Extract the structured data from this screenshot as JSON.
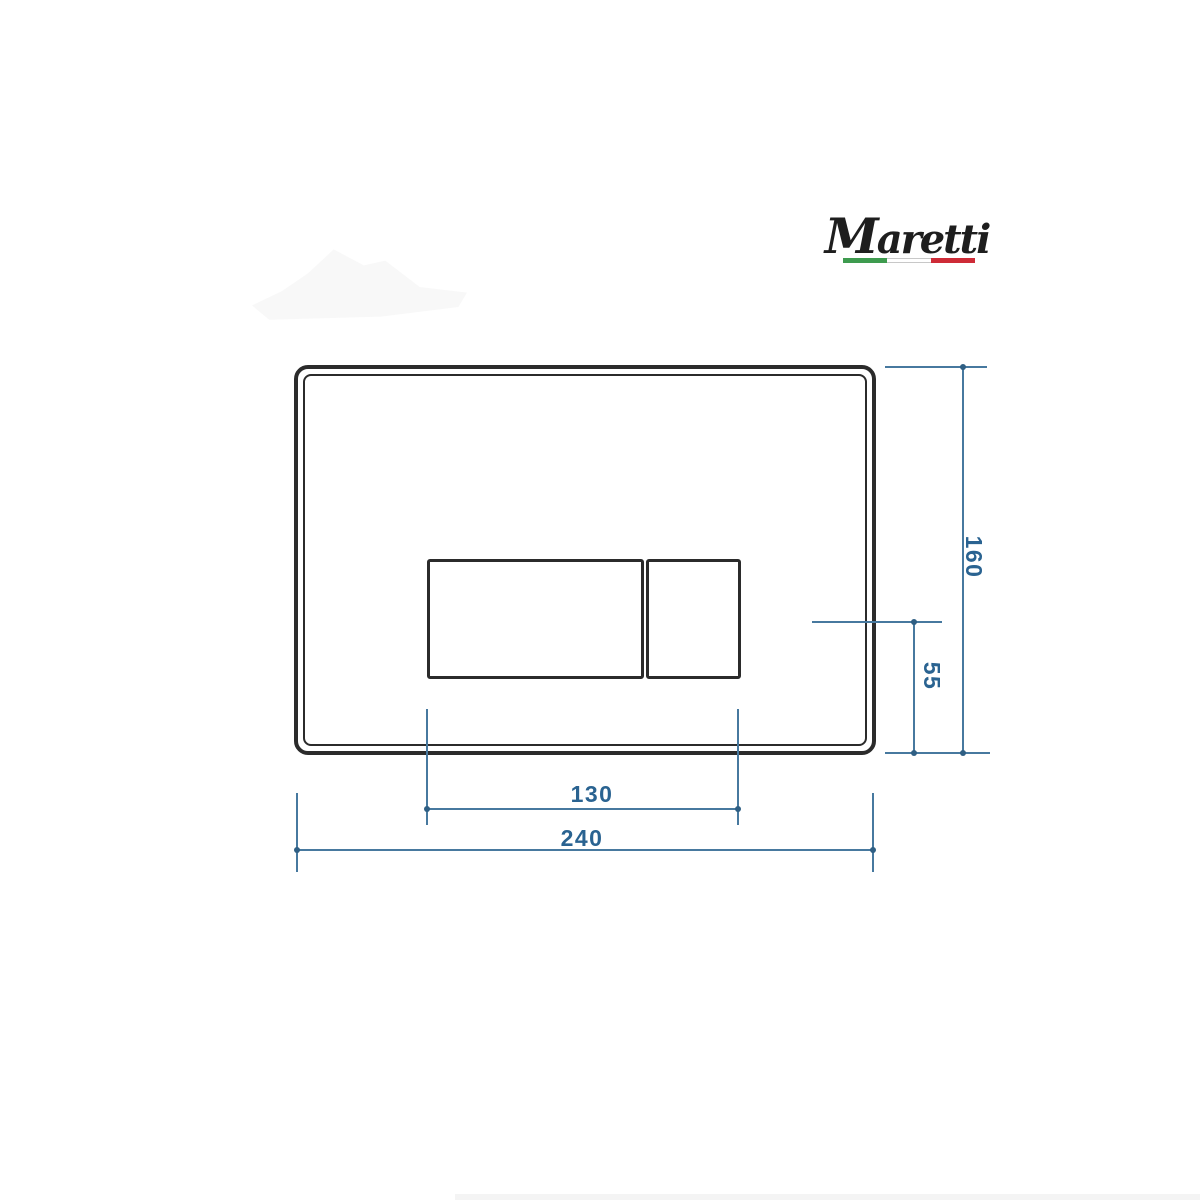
{
  "brand": {
    "name": "Maretti",
    "flag_colors": {
      "green": "#3e9b4f",
      "white": "#ffffff",
      "red": "#ce2b37"
    }
  },
  "drawing": {
    "subject": "flush plate front view with dual buttons",
    "plate_line_color": "#2b2b2b",
    "dimension_line_color": "#47799f",
    "dimension_text_color": "#2a6391",
    "dims": {
      "plate_height": "160",
      "button_axis_offset": "55",
      "buttons_width": "130",
      "plate_width": "240"
    }
  }
}
